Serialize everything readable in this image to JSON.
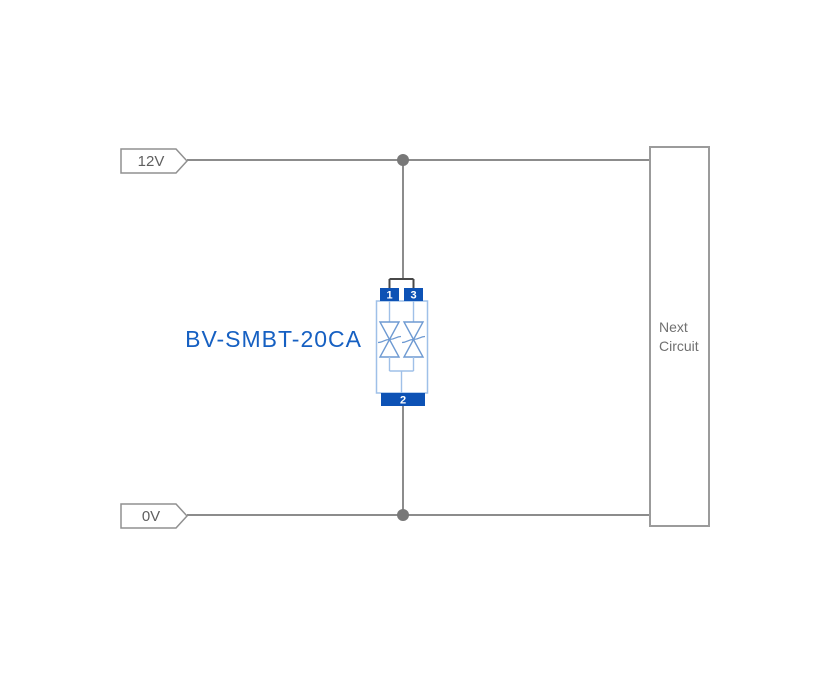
{
  "rails": {
    "top": "12V",
    "bottom": "0V"
  },
  "component": {
    "label": "BV-SMBT-20CA",
    "pins": {
      "pin1": "1",
      "pin2": "2",
      "pin3": "3"
    }
  },
  "next_circuit": {
    "line1": "Next",
    "line2": "Circuit"
  },
  "colors": {
    "wire": "#8c8c8c",
    "junction_dot": "#787878",
    "component_lead": "#484848",
    "tag_border": "#909090",
    "tag_text": "#5f5f5f",
    "box_border": "#9b9b9b",
    "box_text": "#707070",
    "component_body_stroke": "#9fc0e8",
    "component_symbol_stroke": "#6e9ad2",
    "pin_fill": "#0d52b5",
    "component_label_text": "#1660c2"
  }
}
